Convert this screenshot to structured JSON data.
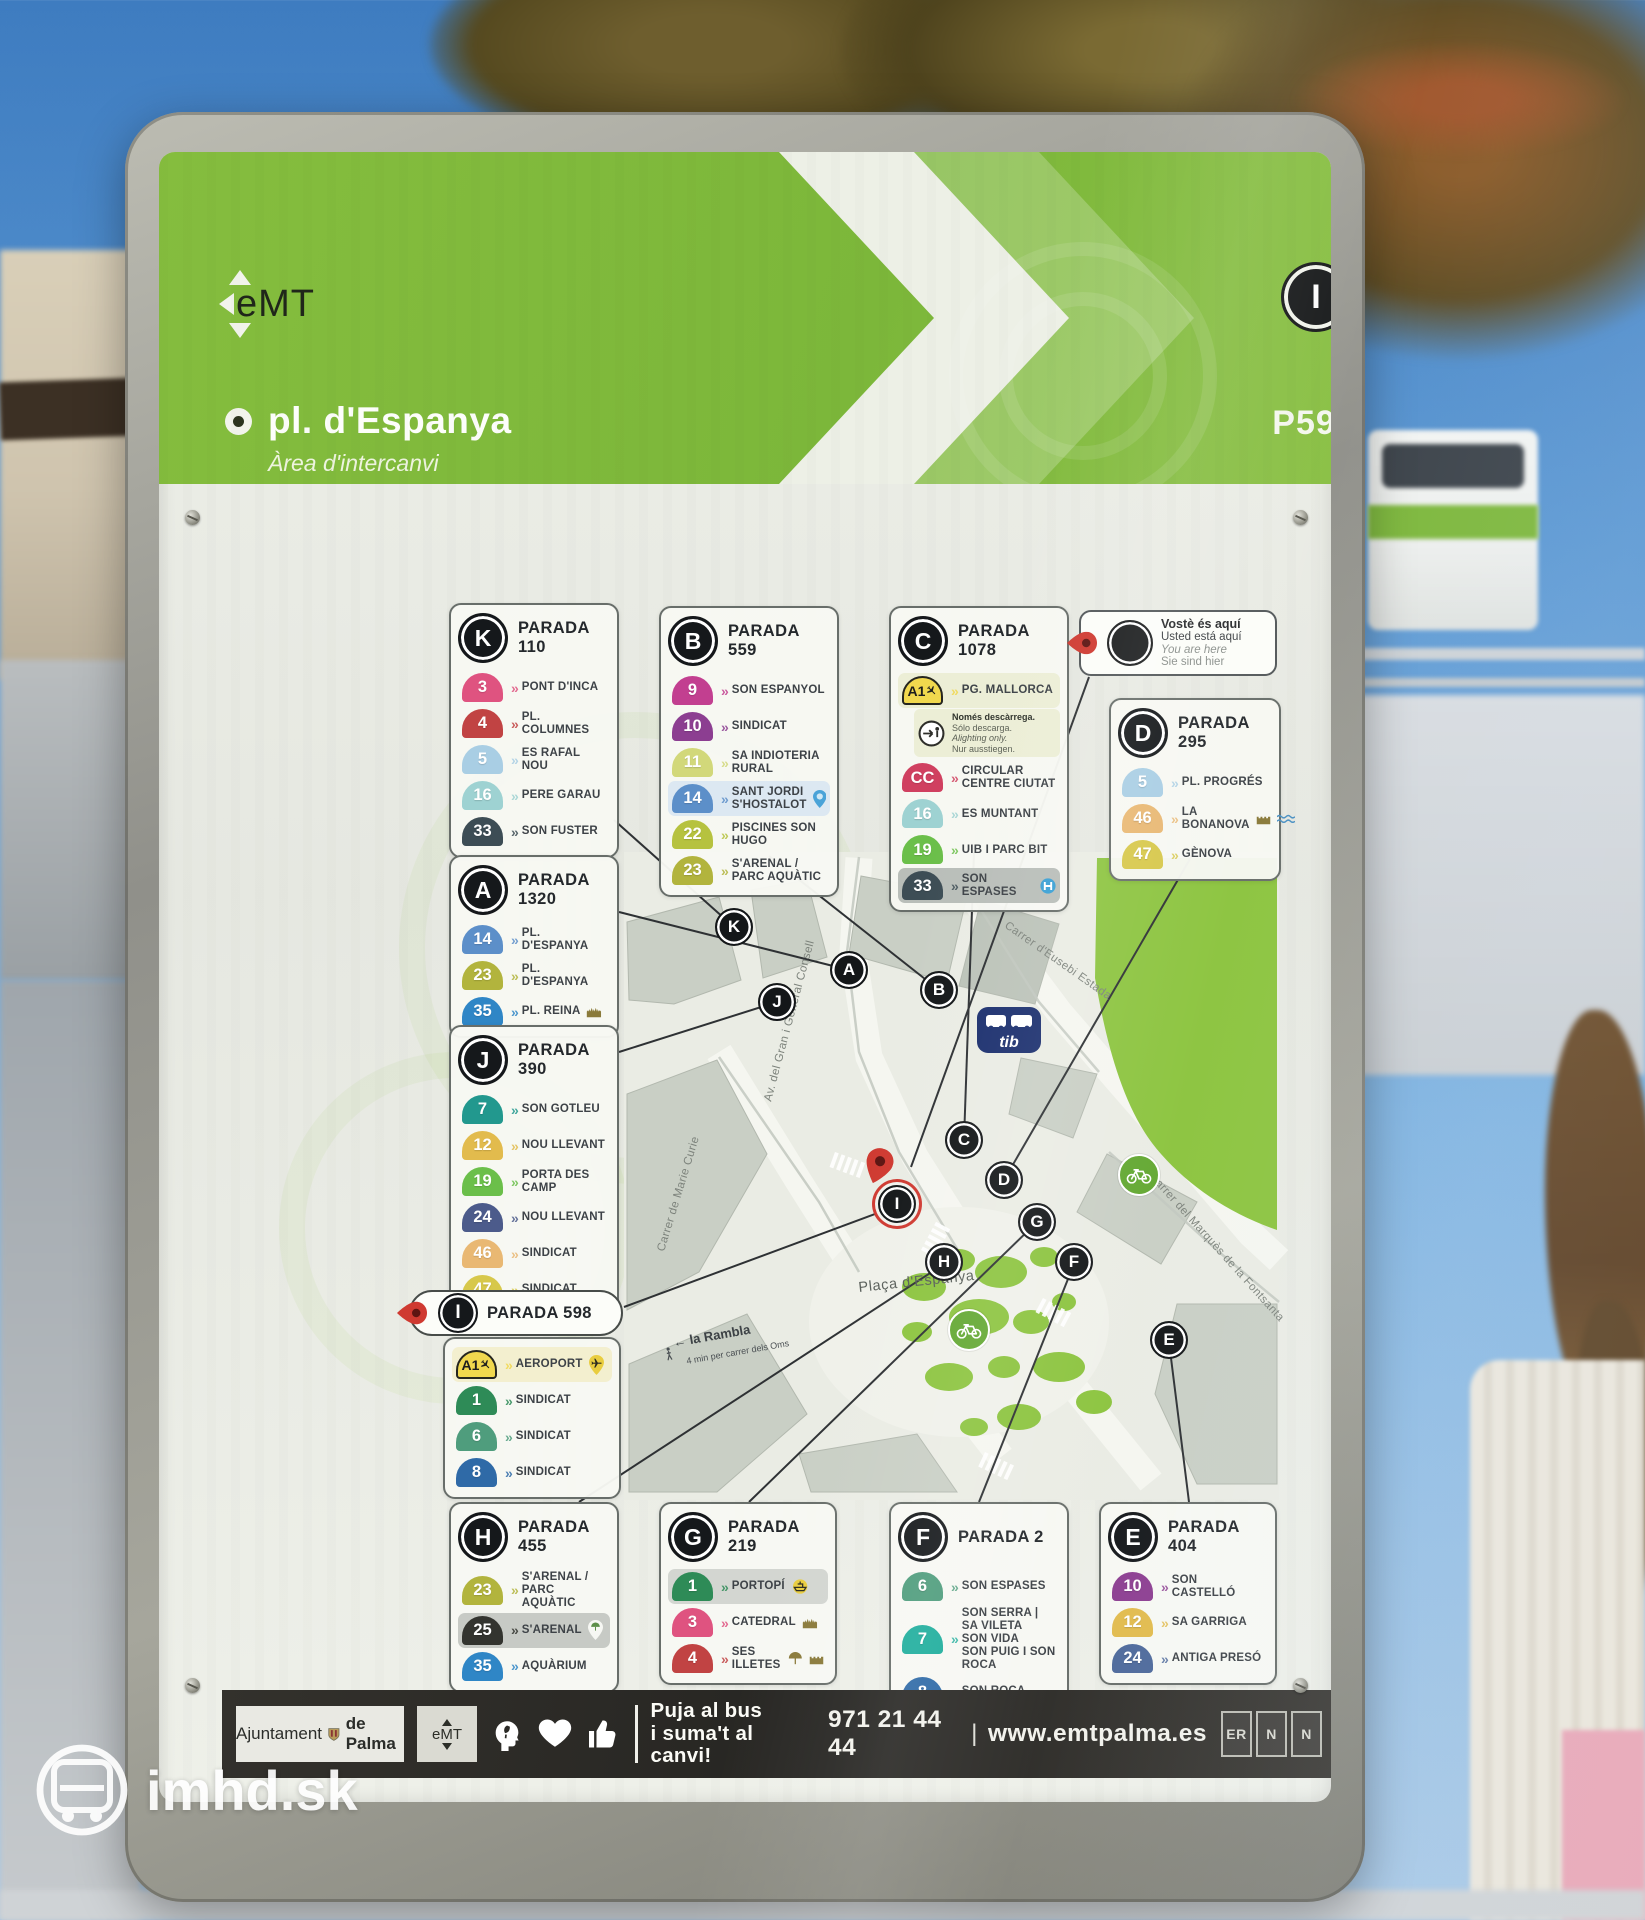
{
  "header": {
    "agency_logo": "eMT",
    "title": "pl. d'Espanya",
    "subtitle": "Àrea d'intercanvi",
    "stop_letter": "I",
    "stop_code": "P598"
  },
  "you_are_here": {
    "lines": [
      "Vostè és aquí",
      "Usted está aquí",
      "You are here",
      "Sie sind hier"
    ]
  },
  "paradas": [
    {
      "id": "K",
      "letter": "K",
      "title": "PARADA 110",
      "routes": [
        {
          "num": "3",
          "color": "#df5380",
          "dest": [
            "PONT D'INCA"
          ]
        },
        {
          "num": "4",
          "color": "#c14343",
          "dest": [
            "PL. COLUMNES"
          ]
        },
        {
          "num": "5",
          "color": "#a9cee4",
          "dest": [
            "ES RAFAL NOU"
          ]
        },
        {
          "num": "16",
          "color": "#9ed2d2",
          "dest": [
            "PERE GARAU"
          ]
        },
        {
          "num": "33",
          "color": "#3d4d55",
          "dest": [
            "SON FUSTER"
          ]
        }
      ]
    },
    {
      "id": "B",
      "letter": "B",
      "title": "PARADA 559",
      "routes": [
        {
          "num": "9",
          "color": "#c23f90",
          "dest": [
            "SON ESPANYOL"
          ]
        },
        {
          "num": "10",
          "color": "#8c3e91",
          "dest": [
            "SINDICAT"
          ]
        },
        {
          "num": "11",
          "color": "#d2d87a",
          "dest": [
            "SA INDIOTERIA RURAL"
          ]
        },
        {
          "num": "14",
          "color": "#5c8fc9",
          "dest": [
            "SANT JORDI",
            "S'HOSTALOT"
          ],
          "highlight": "#dce8f2",
          "icons": [
            "pin-blue"
          ]
        },
        {
          "num": "22",
          "color": "#b6c23f",
          "dest": [
            "PISCINES SON HUGO"
          ]
        },
        {
          "num": "23",
          "color": "#b2b43d",
          "dest": [
            "S'ARENAL /",
            "PARC AQUÀTIC"
          ]
        }
      ]
    },
    {
      "id": "C",
      "letter": "C",
      "title": "PARADA 1078",
      "routes": [
        {
          "num": "A1",
          "color": "#f1d84e",
          "dest": [
            "PG. MALLORCA"
          ],
          "badge_style": "airport",
          "highlight": "#eceed6",
          "note": {
            "lines": [
              "Només descàrrega.",
              "Sólo descarga.",
              "Alighting only.",
              "Nur ausstiegen."
            ]
          }
        },
        {
          "num": "CC",
          "color": "#d04060",
          "dest": [
            "CIRCULAR",
            "CENTRE CIUTAT"
          ]
        },
        {
          "num": "16",
          "color": "#9ed2d2",
          "dest": [
            "ES MUNTANT"
          ]
        },
        {
          "num": "19",
          "color": "#6bbf4a",
          "dest": [
            "UIB I PARC BIT"
          ]
        },
        {
          "num": "33",
          "color": "#3d4d55",
          "dest": [
            "SON ESPASES"
          ],
          "highlight": "#b9beb9",
          "icons": [
            "hospital"
          ]
        }
      ]
    },
    {
      "id": "D",
      "letter": "D",
      "title": "PARADA 295",
      "routes": [
        {
          "num": "5",
          "color": "#a9cee4",
          "dest": [
            "PL. PROGRÉS"
          ]
        },
        {
          "num": "46",
          "color": "#e9b873",
          "dest": [
            "LA BONANOVA"
          ],
          "icons": [
            "castle",
            "waves"
          ]
        },
        {
          "num": "47",
          "color": "#d7c84b",
          "dest": [
            "GÈNOVA"
          ]
        }
      ]
    },
    {
      "id": "A",
      "letter": "A",
      "title": "PARADA 1320",
      "routes": [
        {
          "num": "14",
          "color": "#5c8fc9",
          "dest": [
            "PL. D'ESPANYA"
          ]
        },
        {
          "num": "23",
          "color": "#b2b43d",
          "dest": [
            "PL. D'ESPANYA"
          ]
        },
        {
          "num": "35",
          "color": "#2f86c6",
          "dest": [
            "PL. REINA"
          ],
          "icons": [
            "cathedral"
          ]
        }
      ]
    },
    {
      "id": "J",
      "letter": "J",
      "title": "PARADA 390",
      "routes": [
        {
          "num": "7",
          "color": "#22988e",
          "dest": [
            "SON GOTLEU"
          ]
        },
        {
          "num": "12",
          "color": "#e2bb4d",
          "dest": [
            "NOU LLEVANT"
          ]
        },
        {
          "num": "19",
          "color": "#6bbf4a",
          "dest": [
            "PORTA DES CAMP"
          ]
        },
        {
          "num": "24",
          "color": "#4c5b8b",
          "dest": [
            "NOU LLEVANT"
          ]
        },
        {
          "num": "46",
          "color": "#e9b873",
          "dest": [
            "SINDICAT"
          ]
        },
        {
          "num": "47",
          "color": "#d7c84b",
          "dest": [
            "SINDICAT"
          ]
        }
      ]
    },
    {
      "id": "I",
      "letter": "I",
      "title": "PARADA 598",
      "you_are_here": true,
      "routes": [
        {
          "num": "A1",
          "color": "#f1d84e",
          "dest": [
            "AEROPORT"
          ],
          "badge_style": "airport",
          "highlight": "#f3efcf",
          "icons": [
            "plane-pin"
          ]
        },
        {
          "num": "1",
          "color": "#2e8b57",
          "dest": [
            "SINDICAT"
          ]
        },
        {
          "num": "6",
          "color": "#4f9d7d",
          "dest": [
            "SINDICAT"
          ]
        },
        {
          "num": "8",
          "color": "#2f6aa7",
          "dest": [
            "SINDICAT"
          ]
        }
      ]
    },
    {
      "id": "H",
      "letter": "H",
      "title": "PARADA 455",
      "routes": [
        {
          "num": "23",
          "color": "#b2b43d",
          "dest": [
            "S'ARENAL /",
            "PARC AQUÀTIC"
          ]
        },
        {
          "num": "25",
          "color": "#33342f",
          "dest": [
            "S'ARENAL"
          ],
          "highlight": "#c7cac5",
          "icons": [
            "umbrella-pin"
          ]
        },
        {
          "num": "35",
          "color": "#2f86c6",
          "dest": [
            "AQUÀRIUM"
          ]
        }
      ]
    },
    {
      "id": "G",
      "letter": "G",
      "title": "PARADA 219",
      "routes": [
        {
          "num": "1",
          "color": "#2e8b57",
          "dest": [
            "PORTOPÍ"
          ],
          "highlight": "#d3d6d1",
          "icons": [
            "ship"
          ]
        },
        {
          "num": "3",
          "color": "#df5380",
          "dest": [
            "CATEDRAL"
          ],
          "icons": [
            "cathedral"
          ]
        },
        {
          "num": "4",
          "color": "#c14343",
          "dest": [
            "SES ILLETES"
          ],
          "icons": [
            "umbrella",
            "castle"
          ]
        }
      ]
    },
    {
      "id": "F",
      "letter": "F",
      "title": "PARADA 2",
      "routes": [
        {
          "num": "6",
          "color": "#4f9d7d",
          "dest": [
            "SON ESPASES"
          ]
        },
        {
          "num": "7",
          "color": "#1fae9d",
          "dest": [
            "SON SERRA | SA VILETA",
            "SON VIDA",
            "SON PUIG I SON ROCA"
          ]
        },
        {
          "num": "8",
          "color": "#2f6aa7",
          "dest": [
            "SON ROCA"
          ]
        }
      ]
    },
    {
      "id": "E",
      "letter": "E",
      "title": "PARADA 404",
      "routes": [
        {
          "num": "10",
          "color": "#8c3e91",
          "dest": [
            "SON CASTELLÓ"
          ]
        },
        {
          "num": "12",
          "color": "#e2bb4d",
          "dest": [
            "SA GARRIGA"
          ]
        },
        {
          "num": "24",
          "color": "#4d699b",
          "dest": [
            "ANTIGA PRESÓ"
          ]
        }
      ]
    }
  ],
  "map": {
    "streets": [
      "Av. del Gran i General Consell",
      "Carrer d'Eusebi Estada",
      "Carrer de Marie Curie",
      "Carrer del Marquès de la Fontsanta"
    ],
    "place": "Plaça d'Espanya",
    "rambla": "← la Rambla",
    "rambla_sub": "4 min per carrer dels Oms",
    "tib_label": "tib",
    "markers": [
      "K",
      "A",
      "B",
      "J",
      "C",
      "D",
      "G",
      "H",
      "F",
      "E",
      "I"
    ]
  },
  "footer": {
    "ajuntament_normal": "Ajuntament",
    "ajuntament_bold": "de Palma",
    "emt_logo": "eMT",
    "slogan1": "Puja al bus",
    "slogan2": "i suma't al canvi!",
    "phone": "971 21 44 44",
    "separator": "|",
    "web": "www.emtpalma.es",
    "cert_labels": [
      "ER",
      "N",
      "N"
    ]
  },
  "watermark": {
    "text": "imhd.sk"
  }
}
